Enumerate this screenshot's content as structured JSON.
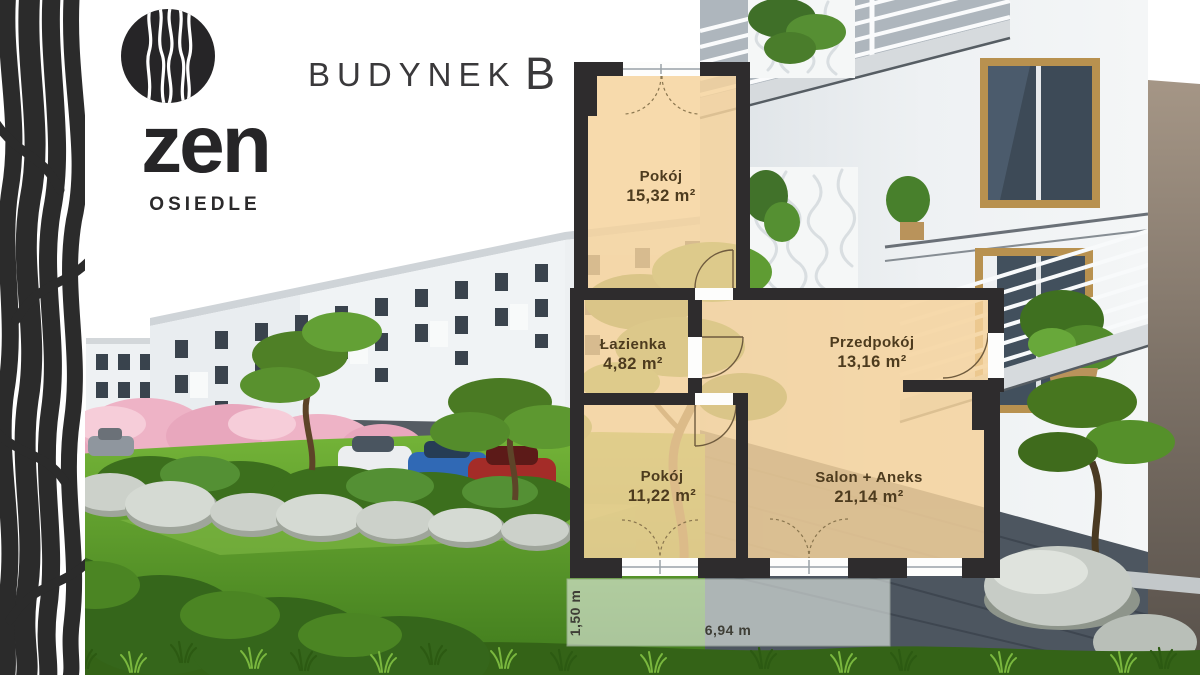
{
  "branding": {
    "logo_icon": "zen-wave-circle-icon",
    "logo_text": "zen",
    "logo_subtext": "OSIEDLE"
  },
  "header": {
    "label": "BUDYNEK",
    "building": "B"
  },
  "floor_plan": {
    "rooms": [
      {
        "name": "Pokój",
        "area": "15,32 m²"
      },
      {
        "name": "Łazienka",
        "area": "4,82 m²"
      },
      {
        "name": "Przedpokój",
        "area": "13,16 m²"
      },
      {
        "name": "Pokój",
        "area": "11,22 m²"
      },
      {
        "name": "Salon + Aneks",
        "area": "21,14 m²"
      }
    ],
    "terrace": {
      "depth": "1,50 m",
      "width": "6,94 m"
    }
  },
  "colors": {
    "wall": "#2e2c2d",
    "room_fill": "#f6d39c",
    "room_label": "#4d3b1e",
    "title_text": "#3a393b",
    "lawn_green": "#69a830",
    "blossom_pink": "#eeb3c6",
    "facade_white": "#f0f3f5",
    "base_grey": "#4d5660"
  }
}
